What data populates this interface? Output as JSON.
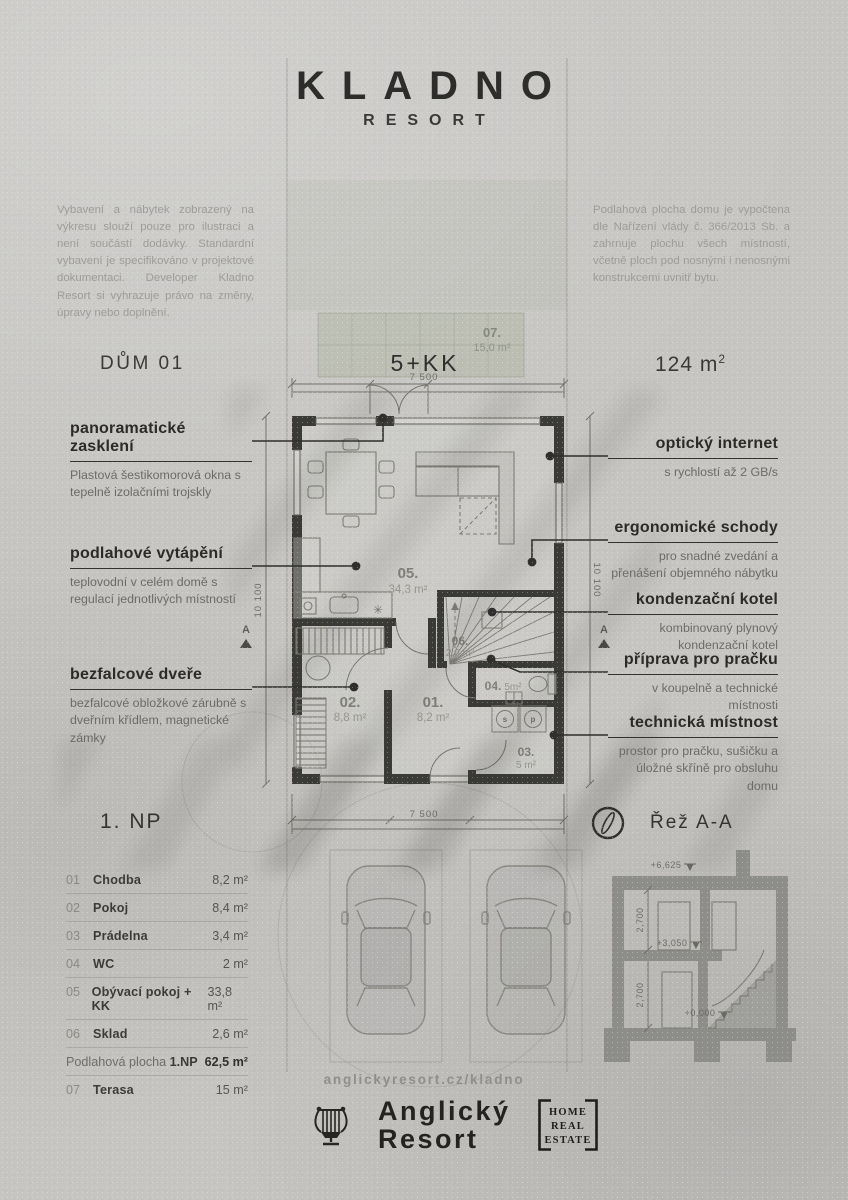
{
  "header": {
    "title": "KLADNO",
    "subtitle": "RESORT"
  },
  "disclaimer_left": "Vybavení a nábytek zobrazený na výkresu slouží pouze pro ilustraci a není součástí dodávky. Standardní vybavení je specifikováno v projektové dokumentaci. Developer Kladno Resort si vyhrazuje právo na změny, úpravy nebo doplnění.",
  "disclaimer_right": "Podlahová plocha domu je vypočtena dle Nařízení vlády č. 366/2013 Sb. a zahrnuje plochu všech místností, včetně ploch pod nosnými i nenosnými konstrukcemi uvnitř bytu.",
  "unit": {
    "house": "DŮM 01",
    "layout": "5+KK",
    "area": "124 m",
    "area_sup": "2"
  },
  "callouts_left": [
    {
      "title": "panoramatické zasklení",
      "desc": "Plastová šestikomorová okna s tepelně izolačními trojskly"
    },
    {
      "title": "podlahové vytápění",
      "desc": "teplovodní v celém domě s regulací jednotlivých místností"
    },
    {
      "title": "bezfalcové dveře",
      "desc": "bezfalcové obložkové zárubně s dveřním křídlem, magnetické zámky"
    }
  ],
  "callouts_right": [
    {
      "title": "optický internet",
      "desc": "s rychlostí až 2 GB/s"
    },
    {
      "title": "ergonomické schody",
      "desc": "pro snadné zvedání a přenášení objemného nábytku"
    },
    {
      "title": "kondenzační kotel",
      "desc": "kombinovaný plynový kondenzační kotel"
    },
    {
      "title": "příprava pro pračku",
      "desc": "v koupelně a technické místnosti"
    },
    {
      "title": "technická místnost",
      "desc": "prostor pro pračku, sušičku a úložné skříně pro obsluhu domu"
    }
  ],
  "plan": {
    "rooms": [
      {
        "no": "05.",
        "area": "34,3 m²"
      },
      {
        "no": "01.",
        "area": "8,2 m²"
      },
      {
        "no": "02.",
        "area": "8,8 m²"
      },
      {
        "no": "03.",
        "area": "5 m²"
      },
      {
        "no": "04.",
        "area": "5m²"
      },
      {
        "no": "06.",
        "area": "2,6 m²"
      }
    ],
    "terrace": {
      "no": "07.",
      "area": "15,0 m²"
    },
    "dims": {
      "width": "7 500",
      "height": "10 100"
    },
    "section_marker": "A",
    "appliances": {
      "washer": "s",
      "dryer": "p",
      "fridge": "✳"
    }
  },
  "floor_label": "1. NP",
  "section_label": "Řež A-A",
  "legend": {
    "rows": [
      {
        "no": "01",
        "name": "Chodba",
        "area": "8,2 m²"
      },
      {
        "no": "02",
        "name": "Pokoj",
        "area": "8,4 m²"
      },
      {
        "no": "03",
        "name": "Prádelna",
        "area": "3,4 m²"
      },
      {
        "no": "04",
        "name": "WC",
        "area": "2 m²"
      },
      {
        "no": "05",
        "name": "Obývací pokoj + KK",
        "area": "33,8 m²"
      },
      {
        "no": "06",
        "name": "Sklad",
        "area": "2,6 m²"
      }
    ],
    "total_label": "Podlahová plocha ",
    "total_floor": "1.NP",
    "total_area": "62,5 m²",
    "terrace_row": {
      "no": "07",
      "name": "Terasa",
      "area": "15 m²"
    }
  },
  "section_drawing": {
    "levels": [
      "+6,625",
      "+3,050",
      "+0,000"
    ],
    "floor_height": "2,700"
  },
  "footer": {
    "url": "anglickyresort.cz/kladno",
    "brand_line1": "Anglický",
    "brand_line2": "Resort",
    "badge_l1": "HOME",
    "badge_l2": "REAL",
    "badge_l3": "ESTATE"
  },
  "colors": {
    "background": "#c6c5c2",
    "ink": "#2d2d2b",
    "wall": "#3a3a37",
    "muted": "#9d9c99",
    "section_gray": "#8d8d89",
    "terrace_green": "#9aa58c"
  }
}
